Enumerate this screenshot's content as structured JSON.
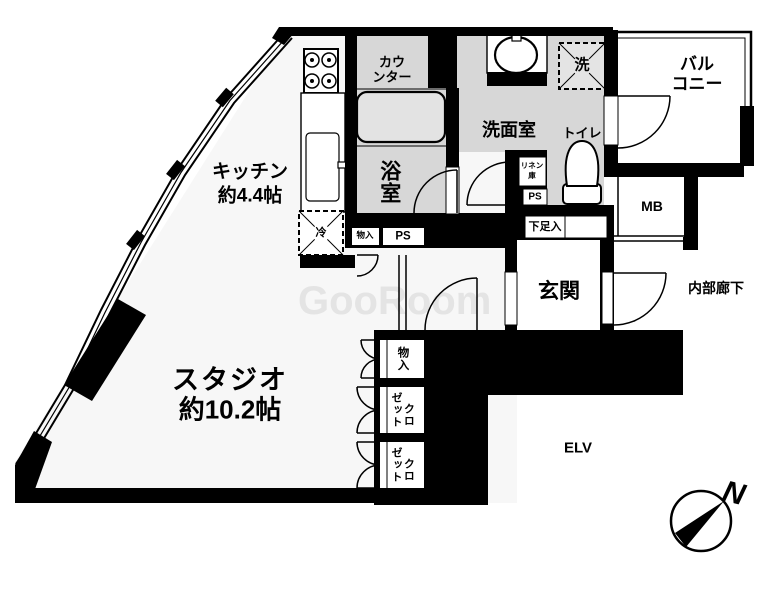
{
  "rooms": {
    "kitchen": {
      "name": "キッチン",
      "size": "約4.4帖"
    },
    "studio": {
      "name": "スタジオ",
      "size": "約10.2帖"
    },
    "bathroom": {
      "name": "浴室"
    },
    "counter": {
      "line1": "カウ",
      "line2": "ンター"
    },
    "washroom": {
      "name": "洗面室"
    },
    "toilet": {
      "name": "トイレ"
    },
    "balcony": {
      "line1": "バル",
      "line2": "コニー"
    },
    "entrance": {
      "name": "玄関"
    },
    "corridor": {
      "name": "内部廊下"
    },
    "elevator": {
      "name": "ELV"
    }
  },
  "fixtures": {
    "washer": "洗",
    "fridge": "冷",
    "meter_box": "MB",
    "shoe_box": "下足入",
    "linen": {
      "line1": "リネン",
      "line2": "庫"
    },
    "pipe_space": "PS",
    "storage": "物入",
    "closet": {
      "right": "クロ",
      "left": "ゼット"
    }
  },
  "compass": {
    "north": "N"
  },
  "watermark": "GooRoom",
  "colors": {
    "wall": "#000000",
    "wet_area": "#d7d7d7",
    "bathtub": "#e3e3e3",
    "washer_box": "#e4e4e4",
    "watermark": "#e4e4e4"
  }
}
